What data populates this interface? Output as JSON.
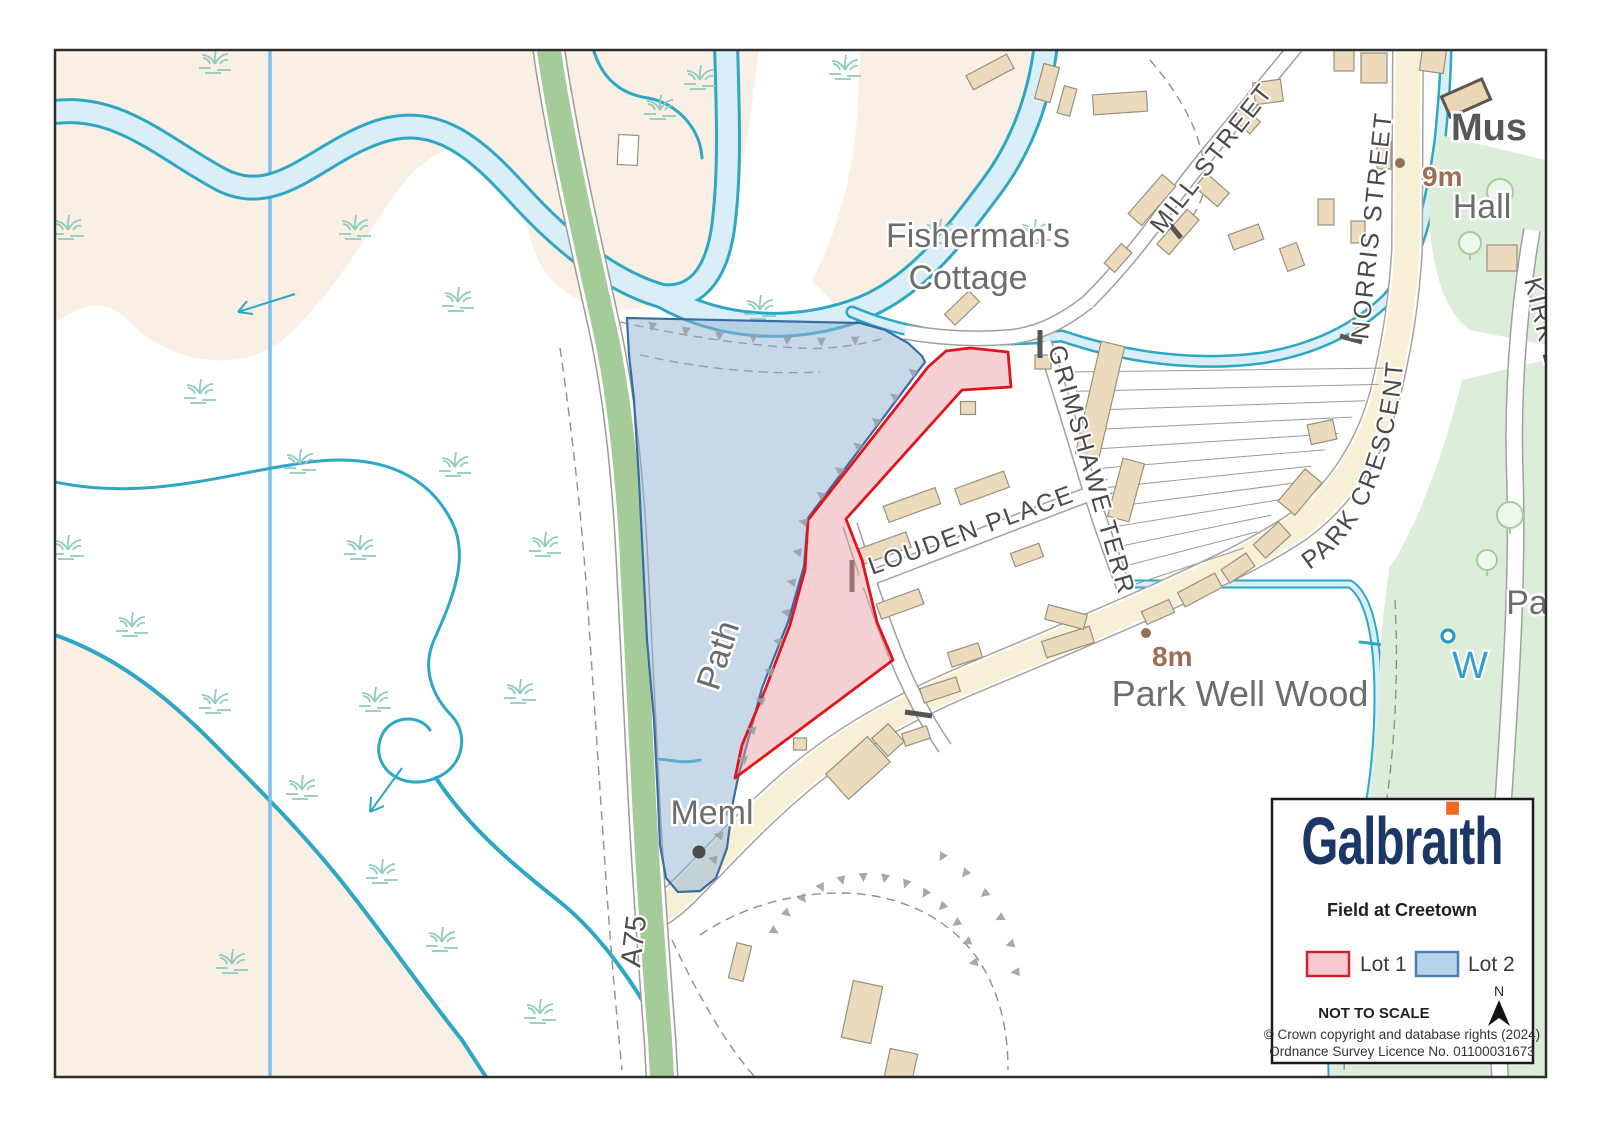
{
  "legend": {
    "brand": "Galbraith",
    "brand_pre": "Galbra",
    "brand_i": "ı",
    "brand_post": "th",
    "title": "Field at Creetown",
    "lot1_label": "Lot 1",
    "lot2_label": "Lot 2",
    "scale_note": "NOT TO SCALE",
    "north_label": "N",
    "copyright_line1": "© Crown copyright and database rights (2024)",
    "copyright_line2": "Ordnance Survey Licence No. 01100031673"
  },
  "map": {
    "labels": {
      "fishermans_line1": "Fisherman's",
      "fishermans_line2": "Cottage",
      "mus": "Mus",
      "hall": "Hall",
      "spot_height_9m": "9m",
      "spot_height_8m": "8m",
      "park_well_wood": "Park Well Wood",
      "meml": "Meml",
      "path": "Path",
      "a75": "A75",
      "w": "W",
      "pa": "Pa",
      "kirk": "KIRK BR"
    },
    "streets": {
      "mill": "MILL STREET",
      "norris": "NORRIS STREET",
      "park_crescent": "PARK CRESCENT",
      "louden": "LOUDEN PLACE",
      "grimshawe": "GRIMSHAWE TERR"
    }
  },
  "colors": {
    "lot1_fill": "#ee96a0",
    "lot1_stroke": "#e0151c",
    "lot2_fill": "#8fb3d3",
    "lot2_stroke": "#3a6ba3",
    "brand_navy": "#1b3766",
    "brand_orange": "#f26a21",
    "river_teal": "#2da7c4",
    "water_fill": "#d9eef6",
    "tidal_flat": "#f9efe4",
    "road_green": "#a4cb98",
    "road_cream": "#f7f0d6",
    "building_fill": "#ecdabd",
    "wood_green": "#dcedda",
    "marsh_green": "#8fccbd",
    "label_gray": "#6d6d6d",
    "spot_brown": "#9b6f55"
  }
}
